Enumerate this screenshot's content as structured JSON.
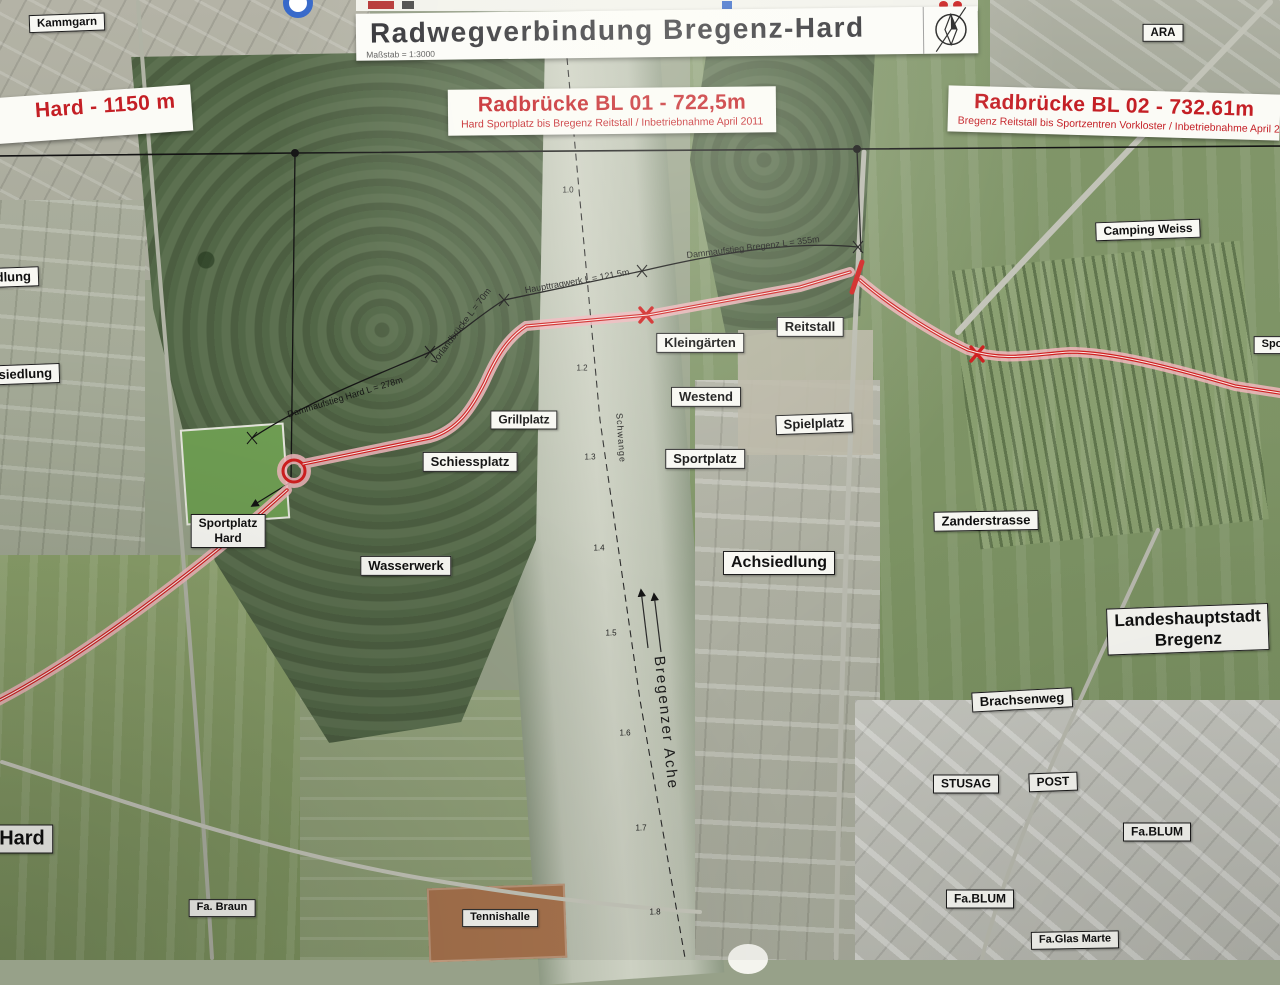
{
  "header": {
    "title": "Radwegverbindung Bregenz-Hard",
    "scale": "Maßstab = 1:3000",
    "north_icon": "north-arrow"
  },
  "info_boxes": [
    {
      "title": "Radbrücke BL 01 - 722,5m",
      "subtitle": "Hard Sportplatz bis Bregenz Reitstall / Inbetriebnahme April 2011"
    },
    {
      "title": "Radbrücke BL 02 - 732.61m",
      "subtitle": "Bregenz Reitstall bis Sportzentren Vorkloster / Inbetriebnahme April 2011"
    },
    {
      "title": "Hard - 1150 m",
      "subtitle": "April 2011"
    }
  ],
  "place_labels": [
    {
      "text": "Kammgarn",
      "x": 67,
      "y": 23,
      "fs": 11.5,
      "rot": -2
    },
    {
      "text": "ARA",
      "x": 1163,
      "y": 33,
      "fs": 11.5,
      "rot": 0
    },
    {
      "text": "Camping Weiss",
      "x": 1148,
      "y": 230,
      "fs": 12,
      "rot": -2
    },
    {
      "text": "Reitstall",
      "x": 810,
      "y": 327,
      "fs": 13,
      "rot": 0
    },
    {
      "text": "Kleingärten",
      "x": 700,
      "y": 343,
      "fs": 13,
      "rot": 0
    },
    {
      "text": "Westend",
      "x": 706,
      "y": 397,
      "fs": 13,
      "rot": 0
    },
    {
      "text": "Grillplatz",
      "x": 524,
      "y": 420,
      "fs": 12,
      "rot": 0
    },
    {
      "text": "Schiessplatz",
      "x": 470,
      "y": 462,
      "fs": 13,
      "rot": 0
    },
    {
      "text": "Spielplatz",
      "x": 814,
      "y": 424,
      "fs": 13,
      "rot": -2
    },
    {
      "text": "Sportplatz",
      "x": 705,
      "y": 459,
      "fs": 13,
      "rot": 0
    },
    {
      "text": "Achsiedlung",
      "x": 779,
      "y": 563,
      "fs": 16,
      "rot": 0
    },
    {
      "text": "Sportplatz\nHard",
      "x": 228,
      "y": 531,
      "fs": 12,
      "rot": 0
    },
    {
      "text": "Wasserwerk",
      "x": 406,
      "y": 566,
      "fs": 13,
      "rot": 0
    },
    {
      "text": "Zanderstrasse",
      "x": 986,
      "y": 521,
      "fs": 13,
      "rot": -1
    },
    {
      "text": "Landeshauptstadt Bregenz",
      "x": 1188,
      "y": 629,
      "fs": 17,
      "rot": -2
    },
    {
      "text": "Brachsenweg",
      "x": 1022,
      "y": 700,
      "fs": 13,
      "rot": -3
    },
    {
      "text": "STUSAG",
      "x": 966,
      "y": 784,
      "fs": 12,
      "rot": 0
    },
    {
      "text": "POST",
      "x": 1053,
      "y": 782,
      "fs": 12,
      "rot": -2
    },
    {
      "text": "Fa.BLUM",
      "x": 1157,
      "y": 832,
      "fs": 12,
      "rot": 0
    },
    {
      "text": "Fa.BLUM",
      "x": 980,
      "y": 899,
      "fs": 12,
      "rot": 0
    },
    {
      "text": "Fa.Glas Marte",
      "x": 1075,
      "y": 940,
      "fs": 11,
      "rot": -1
    },
    {
      "text": "Hard",
      "x": 22,
      "y": 839,
      "fs": 20,
      "rot": 0
    },
    {
      "text": "Fa. Braun",
      "x": 222,
      "y": 908,
      "fs": 11,
      "rot": 0
    },
    {
      "text": "Tennishalle",
      "x": 500,
      "y": 918,
      "fs": 11,
      "rot": 0
    },
    {
      "text": "Achsiedlung",
      "x": -8,
      "y": 278,
      "fs": 13,
      "rot": -2
    },
    {
      "text": "Werkssiedlung",
      "x": 6,
      "y": 375,
      "fs": 13,
      "rot": -2
    },
    {
      "text": "Spo",
      "x": 1272,
      "y": 345,
      "fs": 11,
      "rot": 0
    }
  ],
  "route_labels": [
    {
      "text": "Dammaufstieg Hard   L = 278m",
      "x": 345,
      "y": 397,
      "rot": -17
    },
    {
      "text": "Vorlandbrücke L = 70m",
      "x": 461,
      "y": 326,
      "rot": -53
    },
    {
      "text": "Haupttragwerk L = 121.5m",
      "x": 577,
      "y": 281,
      "rot": -10
    },
    {
      "text": "Dammaufstieg Bregenz L = 355m",
      "x": 753,
      "y": 247,
      "rot": -7
    }
  ],
  "river": {
    "name": "Bregenzer Ache",
    "channel": "Schwange"
  },
  "chainage": [
    {
      "text": "1.0",
      "x": 568,
      "y": 190
    },
    {
      "text": "1.2",
      "x": 582,
      "y": 368
    },
    {
      "text": "1.3",
      "x": 590,
      "y": 457
    },
    {
      "text": "1.4",
      "x": 599,
      "y": 548
    },
    {
      "text": "1.5",
      "x": 611,
      "y": 633
    },
    {
      "text": "1.6",
      "x": 625,
      "y": 733
    },
    {
      "text": "1.7",
      "x": 641,
      "y": 828
    },
    {
      "text": "1.8",
      "x": 655,
      "y": 912
    }
  ],
  "colors": {
    "route_red": "#cf1f1f",
    "route_pink": "#f0b6bc",
    "heading_red": "#c41f25",
    "ink": "#141414",
    "label_bg": "#f8f8f3"
  }
}
